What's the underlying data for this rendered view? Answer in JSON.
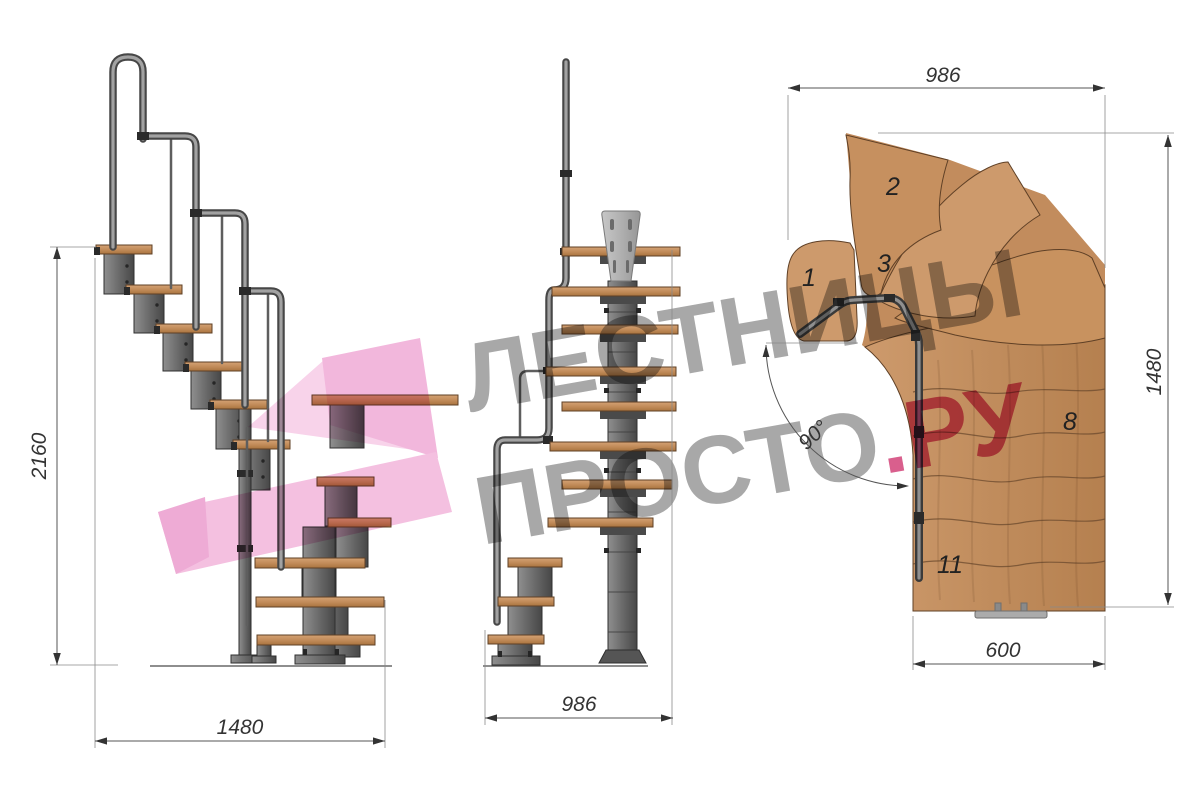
{
  "dimensions": {
    "side_height": "2160",
    "side_width": "1480",
    "front_width": "986",
    "plan_width_top": "986",
    "plan_height_right": "1480",
    "plan_width_bottom": "600",
    "plan_turn_angle": "90°"
  },
  "step_labels": {
    "step1": "1",
    "step2": "2",
    "step3": "3",
    "step8": "8",
    "step11": "11"
  },
  "watermark": {
    "line1": "ЛЕСТНИЦЫ",
    "line2_gray": "ПРОСТО",
    "line2_pink": ".РУ",
    "text_gray": "#a8a8a8",
    "accent_pink": "#d95f8d",
    "logo_pink": "#f2b7dc"
  },
  "colors": {
    "background": "#ffffff",
    "wood_light": "#d4a274",
    "wood_dark": "#b17c4c",
    "wood_outline": "#5f4026",
    "metal_light": "#9b9b9b",
    "metal_dark": "#474747",
    "dimension_line": "#555555",
    "dimension_text": "#333333"
  }
}
